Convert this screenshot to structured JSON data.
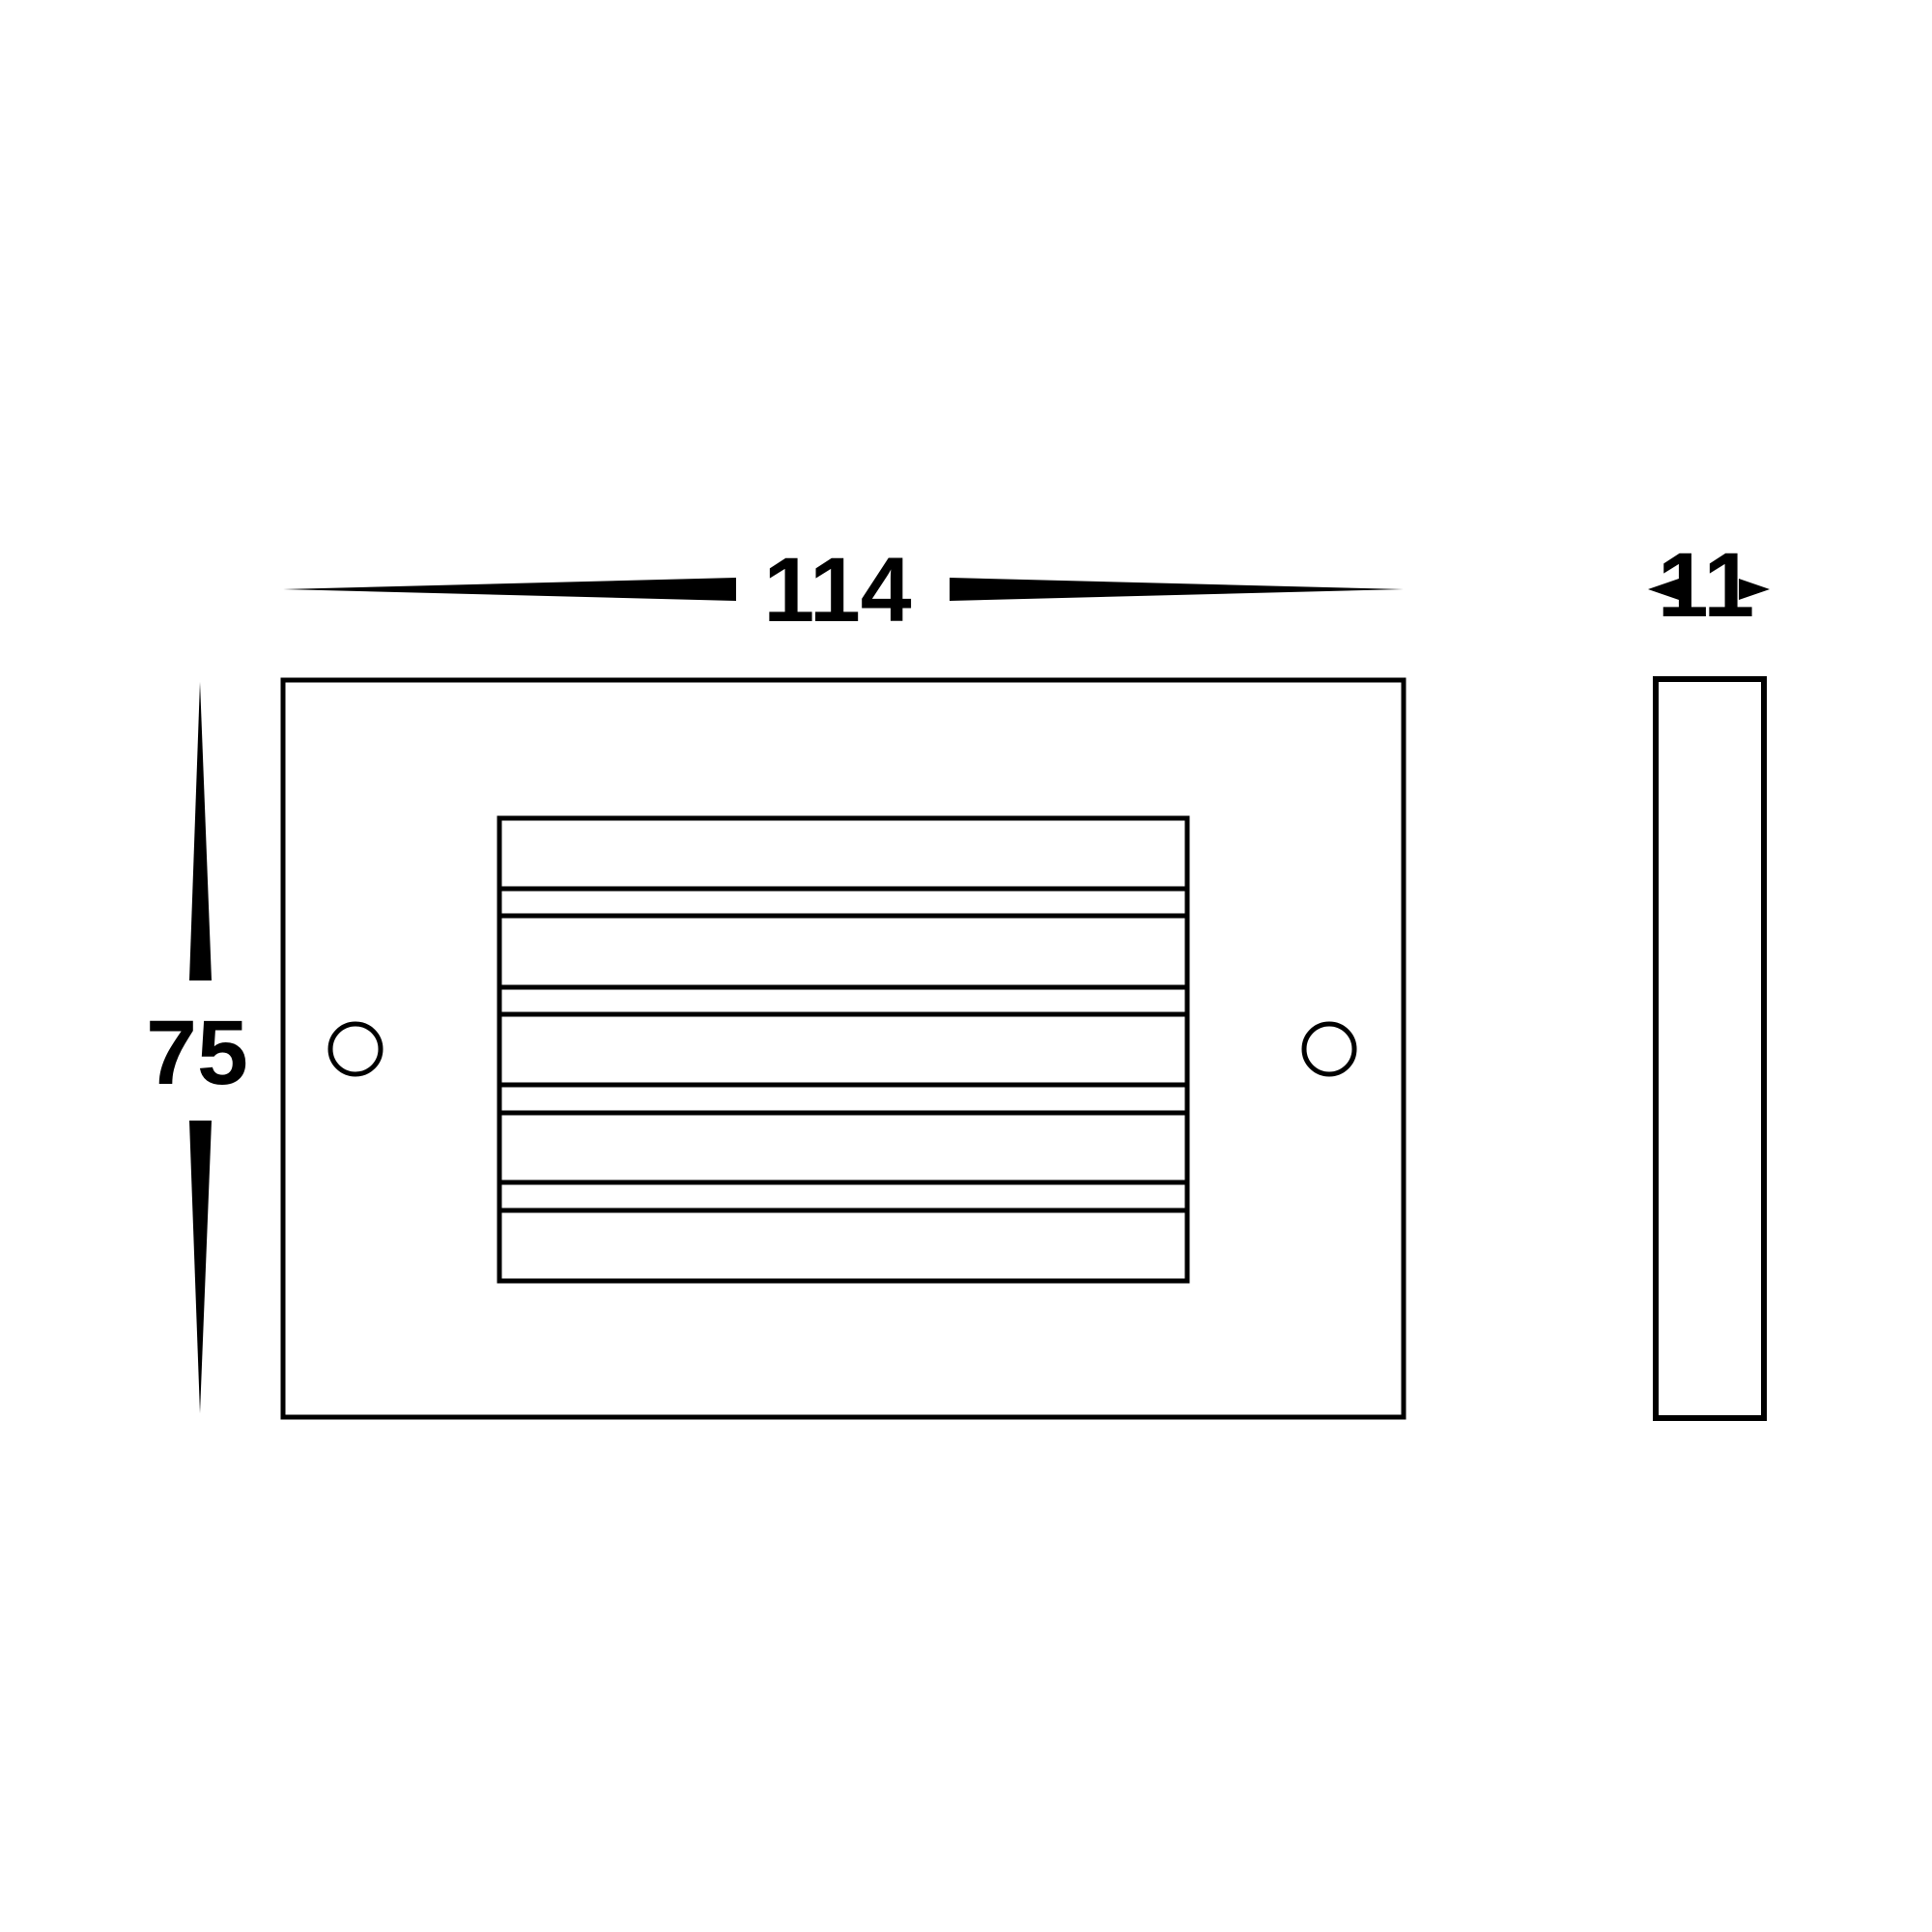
{
  "drawing": {
    "kind": "technical-dimension-drawing",
    "colors": {
      "line": "#000000",
      "background": "#ffffff"
    },
    "dimensions": {
      "width": {
        "label": "114",
        "value": 114
      },
      "height": {
        "label": "75",
        "value": 75
      },
      "depth": {
        "label": "11",
        "value": 11
      }
    },
    "front_view": {
      "louver_slats": 5,
      "louver_gaps": 4,
      "mounting_holes": 2
    },
    "side_view": {
      "panels": 1
    }
  }
}
